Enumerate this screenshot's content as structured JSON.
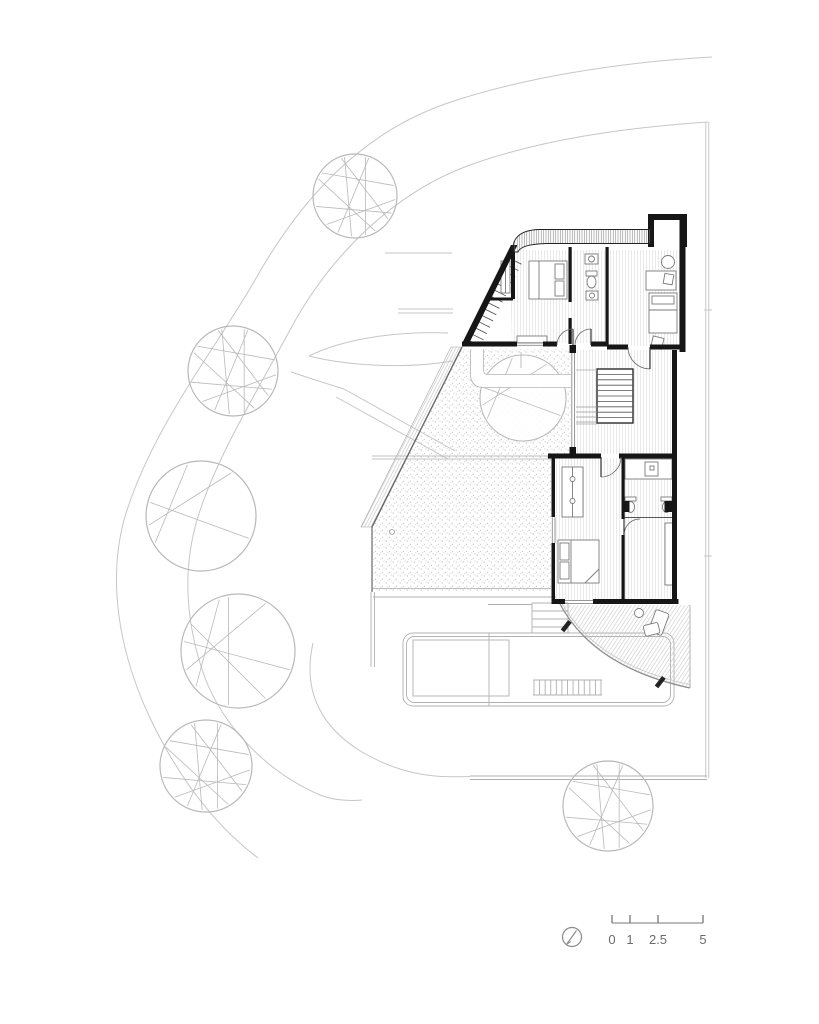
{
  "drawing": {
    "kind": "architectural-floor-plan",
    "background": "#ffffff"
  },
  "palette": {
    "wall": "#161616",
    "dark_line": "#3a3a3a",
    "mid_line": "#8a8a8a",
    "furniture": "#7a7a7a",
    "site_line": "#c6c6c6",
    "tree_line": "#b9b9b9",
    "floor_hatch": "#dcdcdc",
    "stipple": "#b9b9b9",
    "deck_hatch": "#c9c9c9"
  },
  "scale_bar": {
    "x_start": 612,
    "x_end": 703,
    "baseline_y": 923,
    "tick_top_y": 915,
    "label_y": 944,
    "ticks": [
      {
        "x": 612,
        "label": "0"
      },
      {
        "x": 630,
        "label": "1"
      },
      {
        "x": 658,
        "label": "2.5"
      },
      {
        "x": 703,
        "label": "5"
      }
    ]
  },
  "north_indicator": {
    "cx": 572,
    "cy": 937,
    "r": 9.5
  },
  "trees": [
    {
      "cx": 355,
      "cy": 196,
      "r": 42,
      "style": "dense",
      "fill": "none"
    },
    {
      "cx": 233,
      "cy": 371,
      "r": 45,
      "style": "dense",
      "fill": "none"
    },
    {
      "cx": 201,
      "cy": 516,
      "r": 55,
      "style": "light",
      "fill": "none"
    },
    {
      "cx": 238,
      "cy": 651,
      "r": 57,
      "style": "medium",
      "fill": "none"
    },
    {
      "cx": 206,
      "cy": 766,
      "r": 46,
      "style": "dense",
      "fill": "none"
    },
    {
      "cx": 608,
      "cy": 806,
      "r": 45,
      "style": "dense",
      "fill": "none"
    }
  ],
  "courtyard_tree": {
    "cx": 523,
    "cy": 398,
    "r": 43,
    "style": "light",
    "fill": "#ffffff"
  },
  "tree_styles": {
    "dense": [
      [
        95,
        255
      ],
      [
        115,
        290
      ],
      [
        60,
        205
      ],
      [
        25,
        165
      ],
      [
        285,
        75
      ],
      [
        215,
        345
      ],
      [
        135,
        5
      ],
      [
        250,
        35
      ]
    ],
    "medium": [
      [
        140,
        250
      ],
      [
        160,
        300
      ],
      [
        190,
        20
      ],
      [
        210,
        60
      ],
      [
        100,
        260
      ]
    ],
    "light": [
      [
        150,
        255
      ],
      [
        170,
        305
      ],
      [
        195,
        25
      ]
    ]
  },
  "stairs": {
    "central": {
      "x": 597,
      "y": 369,
      "w": 36,
      "h": 54,
      "treads": 9
    },
    "entry_steps": {
      "x1": 576,
      "x2": 597,
      "ys": [
        407,
        412,
        417,
        422
      ]
    },
    "triangle": {
      "top": [
        509,
        258
      ],
      "bottom": [
        468,
        340
      ],
      "treads": 13,
      "len": 14
    },
    "pool": {
      "x1": 534,
      "x2": 601,
      "y1": 680,
      "y2": 695,
      "treads": 12
    },
    "deck_steps": {
      "x1": 532,
      "x2": 568,
      "ys": [
        603,
        611,
        619,
        627
      ]
    }
  }
}
